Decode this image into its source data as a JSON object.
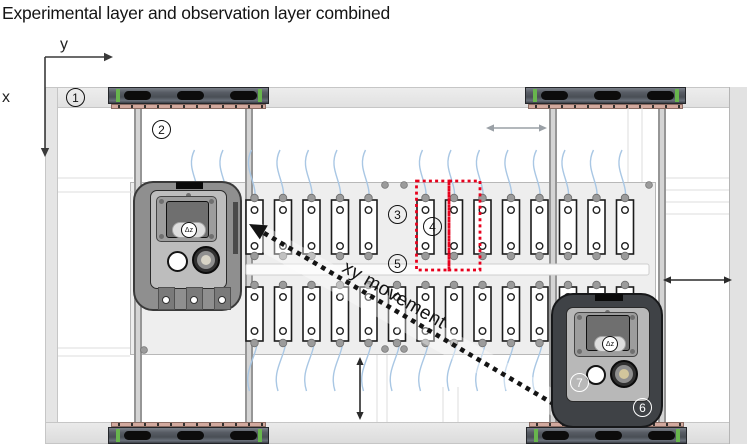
{
  "title": "Experimental layer and observation layer combined",
  "axes": {
    "x_label": "x",
    "y_label": "y"
  },
  "movement_label": "xy movement",
  "markers": [
    "1",
    "2",
    "3",
    "4",
    "5",
    "6",
    "7"
  ],
  "devices": {
    "left": {
      "screen_label": "Δz"
    },
    "right": {
      "screen_label": "Δz"
    }
  },
  "colors": {
    "highlight_red": "#e8001c",
    "wire_blue": "#a9c7e4",
    "carriage_green": "#68b54d",
    "carriage_pink": "#d2a99e",
    "frame_gray": "#e5e5e5",
    "plate_gray": "#eeeeee"
  }
}
